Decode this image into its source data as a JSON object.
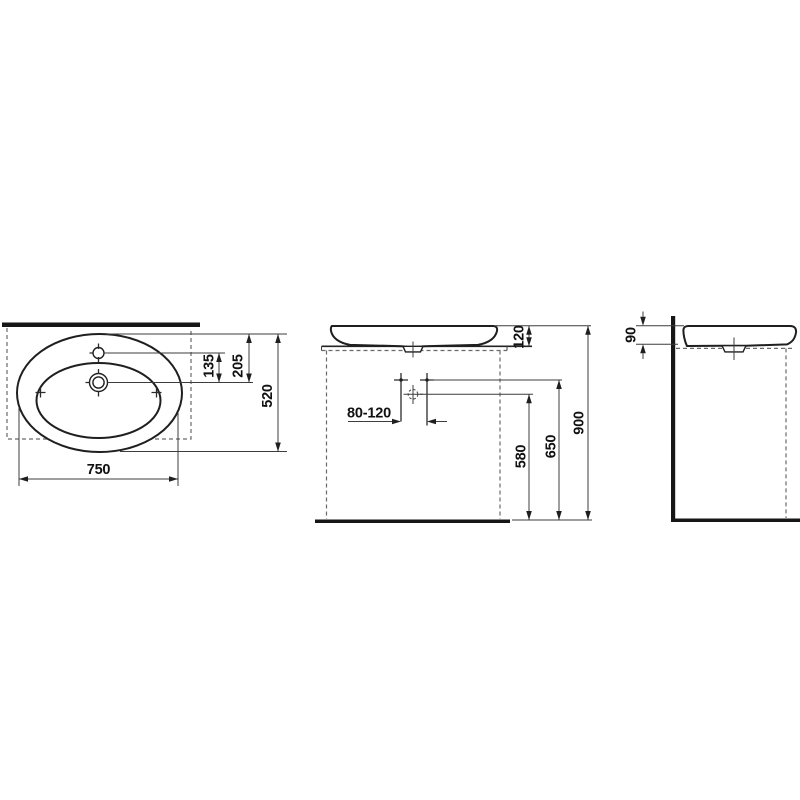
{
  "colors": {
    "line": "#1f1f1f",
    "background": "#ffffff"
  },
  "dimensions": {
    "top_view": {
      "overall_width": "750",
      "overall_depth": "520",
      "tap_to_drain": "135",
      "rear_edge_to_drain": "205"
    },
    "front_view": {
      "basin_height": "120",
      "tap_hole_spacing": "80-120",
      "drain_height": "580",
      "supply_height": "650",
      "overall_height": "900"
    },
    "side_view": {
      "rim_depth": "90"
    }
  }
}
